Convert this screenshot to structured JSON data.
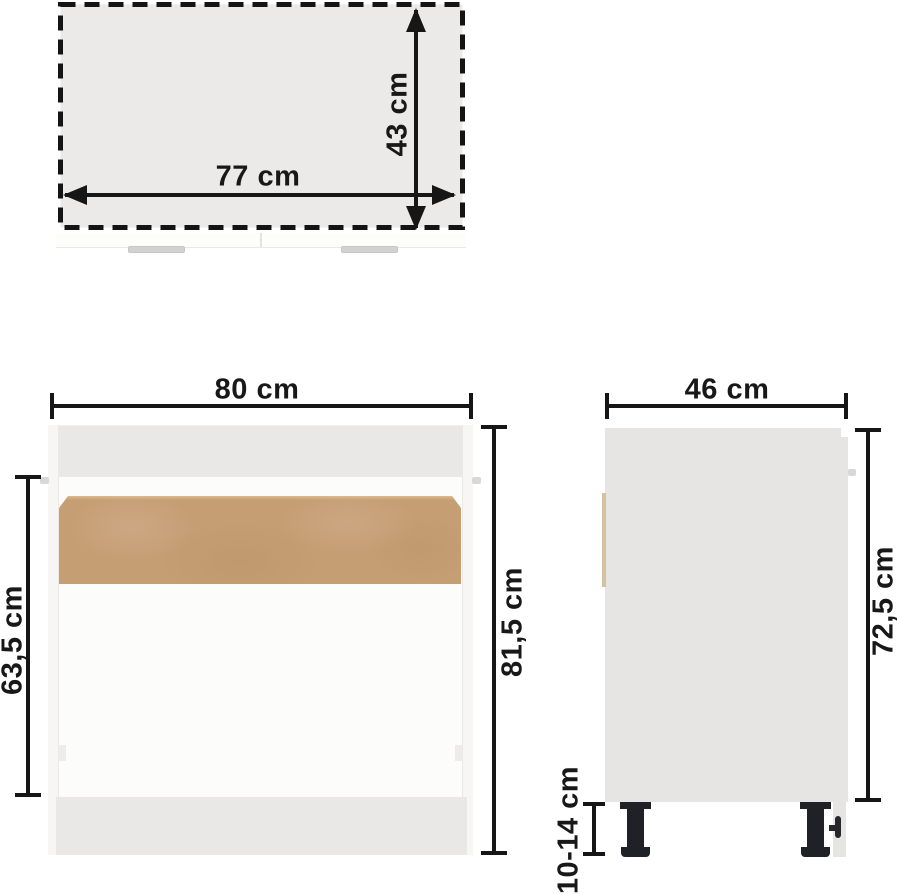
{
  "views": {
    "top": {
      "dimensions": {
        "width": "77 cm",
        "depth": "43 cm"
      }
    },
    "front": {
      "dimensions": {
        "width": "80 cm",
        "total_height": "81,5 cm",
        "interior_height": "63,5 cm"
      }
    },
    "side": {
      "dimensions": {
        "depth": "46 cm",
        "carcass_height": "72,5 cm",
        "leg_height": "10-14 cm"
      }
    }
  },
  "colors": {
    "background": "#ffffff",
    "dimension_ink": "#161616",
    "carcass_gray": "#e9e8e6",
    "top_interior_gray": "#ebeae8",
    "wood_panel": "#c69e74",
    "wood_panel_edge": "#d5c2a3",
    "handle_gray": "#d2d2d2",
    "leg_black": "#202126"
  }
}
